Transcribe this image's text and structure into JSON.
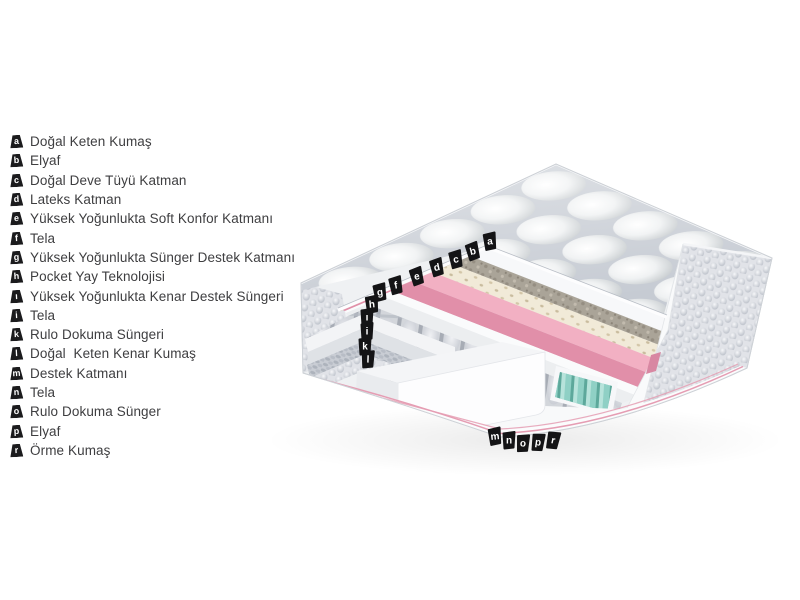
{
  "page": {
    "background": "#ffffff"
  },
  "legend": {
    "text_color": "#3e3e40",
    "badge_color": "#1b1b1d",
    "badge_text_color": "#ffffff",
    "items": [
      {
        "letter": "a",
        "label": "Doğal Keten Kumaş"
      },
      {
        "letter": "b",
        "label": "Elyaf"
      },
      {
        "letter": "c",
        "label": "Doğal Deve Tüyü Katman"
      },
      {
        "letter": "d",
        "label": "Lateks Katman"
      },
      {
        "letter": "e",
        "label": "Yüksek Yoğunlukta Soft Konfor Katmanı"
      },
      {
        "letter": "f",
        "label": "Tela"
      },
      {
        "letter": "g",
        "label": "Yüksek Yoğunlukta Sünger Destek Katmanı"
      },
      {
        "letter": "h",
        "label": "Pocket Yay Teknolojisi"
      },
      {
        "letter": "ı",
        "label": "Yüksek Yoğunlukta Kenar Destek Süngeri"
      },
      {
        "letter": "i",
        "label": "Tela"
      },
      {
        "letter": "k",
        "label": "Rulo Dokuma Süngeri"
      },
      {
        "letter": "l",
        "label": "Doğal  Keten Kenar Kumaş"
      },
      {
        "letter": "m",
        "label": "Destek Katmanı"
      },
      {
        "letter": "n",
        "label": "Tela"
      },
      {
        "letter": "o",
        "label": "Rulo Dokuma Sünger"
      },
      {
        "letter": "p",
        "label": "Elyaf"
      },
      {
        "letter": "r",
        "label": "Örme Kumaş"
      }
    ]
  },
  "diagram": {
    "type": "mattress-layer-cutaway",
    "colors": {
      "flag": "#141416",
      "pink_top": "#f2b0c3",
      "pink_front": "#e18fa9",
      "pink_cap": "#d887a2",
      "piping_pink": "#e59db3",
      "teal": "#8fd0c5",
      "latex": "#f1ead8",
      "camel": "#aaa498",
      "quilt_gap": "#c6cbd3"
    },
    "markers": [
      {
        "letter": "a",
        "x": 490,
        "y": 242,
        "rot": -6
      },
      {
        "letter": "b",
        "x": 473,
        "y": 252,
        "rot": -14
      },
      {
        "letter": "c",
        "x": 456,
        "y": 260,
        "rot": -10
      },
      {
        "letter": "d",
        "x": 437,
        "y": 268,
        "rot": -12
      },
      {
        "letter": "e",
        "x": 417,
        "y": 277,
        "rot": -14
      },
      {
        "letter": "f",
        "x": 396,
        "y": 286,
        "rot": -10
      },
      {
        "letter": "g",
        "x": 380,
        "y": 293,
        "rot": -8
      },
      {
        "letter": "h",
        "x": 372,
        "y": 305,
        "rot": -5
      },
      {
        "letter": "ı",
        "x": 367,
        "y": 318,
        "rot": 0
      },
      {
        "letter": "i",
        "x": 367,
        "y": 332,
        "rot": 0
      },
      {
        "letter": "k",
        "x": 365,
        "y": 347,
        "rot": 0
      },
      {
        "letter": "l",
        "x": 368,
        "y": 360,
        "rot": 2
      },
      {
        "letter": "m",
        "x": 495,
        "y": 437,
        "rot": -6
      },
      {
        "letter": "n",
        "x": 509,
        "y": 441,
        "rot": 0
      },
      {
        "letter": "o",
        "x": 523,
        "y": 444,
        "rot": 4
      },
      {
        "letter": "p",
        "x": 538,
        "y": 443,
        "rot": 8
      },
      {
        "letter": "r",
        "x": 553,
        "y": 441,
        "rot": 12
      }
    ]
  }
}
